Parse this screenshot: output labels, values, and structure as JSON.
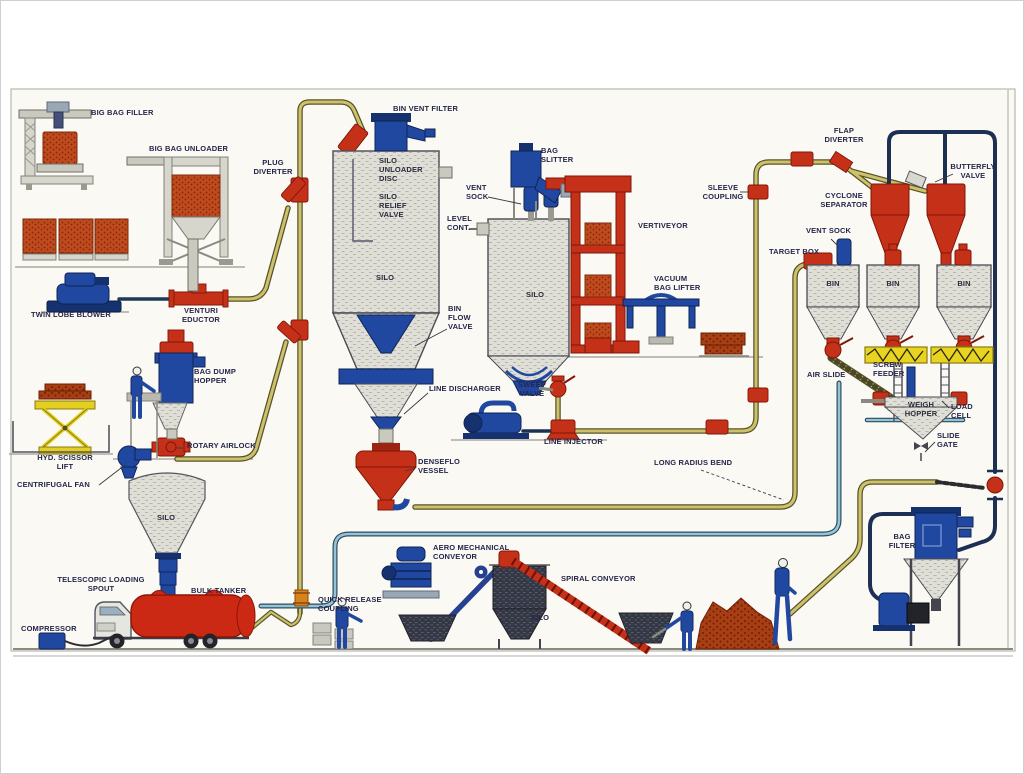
{
  "diagram_type": "pneumatic-conveying-system-process-diagram",
  "colors": {
    "background": "#faf9f4",
    "pipe_yellow": "#cdc26a",
    "pipe_yellow_casing": "#57522a",
    "pipe_teal": "#96c5d2",
    "pipe_navy": "#1d3054",
    "equipment_blue": "#2148a0",
    "equipment_red": "#c53018",
    "silo_hatch_grey": "#dfdfd8",
    "material_orange": "#bf4a1d",
    "feeder_yellow": "#e8d41e",
    "label_text": "#26264a"
  },
  "labels": {
    "big_bag_filler": "BIG BAG FILLER",
    "big_bag_unloader": "BIG BAG UNLOADER",
    "plug_diverter": "PLUG\nDIVERTER",
    "bin_vent_filter": "BIN VENT FILTER",
    "silo_unloader_disc": "SILO\nUNLOADER\nDISC",
    "silo_relief_valve": "SILO\nRELIEF\nVALVE",
    "vent_sock_left": "VENT\nSOCK",
    "level_cont": "LEVEL\nCONT.",
    "bag_slitter": "BAG\nSLITTER",
    "vertiveyor": "VERTIVEYOR",
    "sleeve_coupling": "SLEEVE\nCOUPLING",
    "vacuum_bag_lifter": "VACUUM\nBAG LIFTER",
    "flap_diverter": "FLAP\nDIVERTER",
    "butterfly_valve": "BUTTERFLY\nVALVE",
    "cyclone_separator": "CYCLONE\nSEPARATOR",
    "vent_sock_right": "VENT SOCK",
    "target_box": "TARGET BOX",
    "twin_lobe_blower": "TWIN LOBE BLOWER",
    "venturi_eductor": "VENTURI\nEDUCTOR",
    "silo_main": "SILO",
    "bin_flow_valve": "BIN\nFLOW\nVALVE",
    "silo_2": "SILO",
    "bag_dump_hopper": "BAG DUMP\nHOPPER",
    "rotary_airlock": "ROTARY AIRLOCK",
    "hyd_scissor_lift": "HYD. SCISSOR\nLIFT",
    "centrifugal_fan": "CENTRIFUGAL FAN",
    "silo_left": "SILO",
    "line_discharger": "LINE DISCHARGER",
    "sweep_valve": "SWEEP\nVALVE",
    "line_injector": "LINE INJECTOR",
    "denseflo_vessel": "DENSEFLO\nVESSEL",
    "long_radius_bend": "LONG RADIUS BEND",
    "bin_1": "BIN",
    "bin_2": "BIN",
    "bin_3": "BIN",
    "air_slide": "AIR SLIDE",
    "screw_feeder": "SCREW\nFEEDER",
    "weigh_hopper": "WEIGH\nHOPPER",
    "load_cell": "LOAD\nCELL",
    "slide_gate": "SLIDE\nGATE",
    "telescopic_loading_spout": "TELESCOPIC LOADING\nSPOUT",
    "bulk_tanker": "BULK TANKER",
    "compressor": "COMPRESSOR",
    "quick_release_coupling": "QUICK RELEASE\nCOUPLING",
    "aero_mechanical_conveyor": "AERO MECHANICAL\nCONVEYOR",
    "spiral_conveyor": "SPIRAL CONVEYOR",
    "silo_bottom": "SILO",
    "bag_filter": "BAG\nFILTER"
  }
}
